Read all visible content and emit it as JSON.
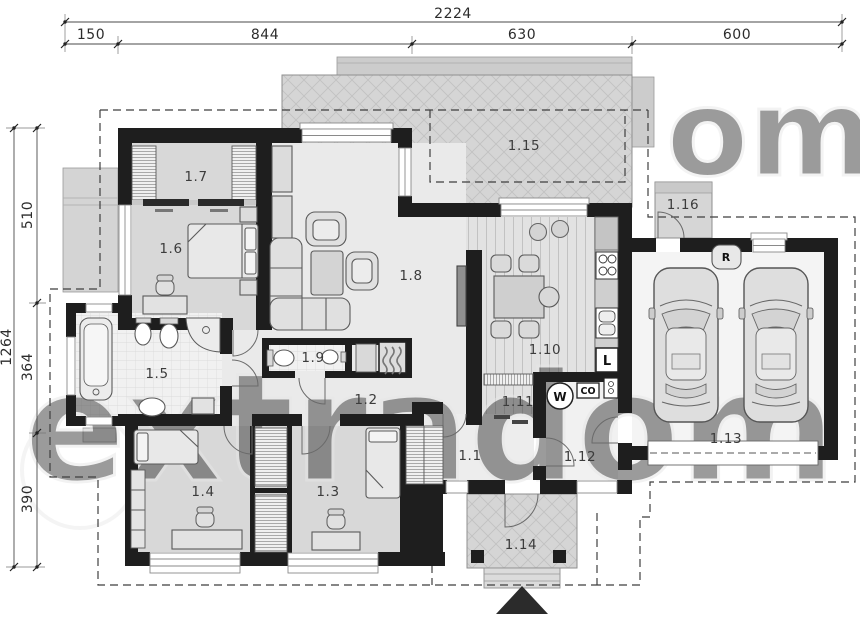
{
  "meta": {
    "title": "Single-storey house floor plan with double garage"
  },
  "dimensions": {
    "top": {
      "total": "2224",
      "segments": [
        "150",
        "844",
        "630",
        "600"
      ]
    },
    "left": {
      "total": "1264",
      "segments": [
        "510",
        "364",
        "390"
      ]
    }
  },
  "rooms": [
    {
      "label": "1.1",
      "name": "hall"
    },
    {
      "label": "1.2",
      "name": "corridor"
    },
    {
      "label": "1.3",
      "name": "bedroom"
    },
    {
      "label": "1.4",
      "name": "bedroom"
    },
    {
      "label": "1.5",
      "name": "bathroom"
    },
    {
      "label": "1.6",
      "name": "bedroom"
    },
    {
      "label": "1.7",
      "name": "wardrobe"
    },
    {
      "label": "1.8",
      "name": "living-room"
    },
    {
      "label": "1.9",
      "name": "wc"
    },
    {
      "label": "1.10",
      "name": "kitchen-dining"
    },
    {
      "label": "1.11",
      "name": "pantry"
    },
    {
      "label": "1.12",
      "name": "utility-room"
    },
    {
      "label": "1.13",
      "name": "garage"
    },
    {
      "label": "1.14",
      "name": "entry-porch"
    },
    {
      "label": "1.15",
      "name": "terrace"
    },
    {
      "label": "1.16",
      "name": "side-entry"
    }
  ],
  "symbols": {
    "washing_machine": "W",
    "boiler": "CO",
    "fridge": "L",
    "recuperator": "R"
  },
  "watermark": {
    "text": "extradom",
    "fragment": "om"
  },
  "colors": {
    "wall": "#1e1e1e",
    "floor_light": "#eaeaea",
    "floor_bedroom": "#d8d8d8",
    "terrace": "#d5d5d5",
    "garage_floor": "#f4f4f4",
    "line": "#555555",
    "dashed_roof": "#3f3f3f"
  }
}
